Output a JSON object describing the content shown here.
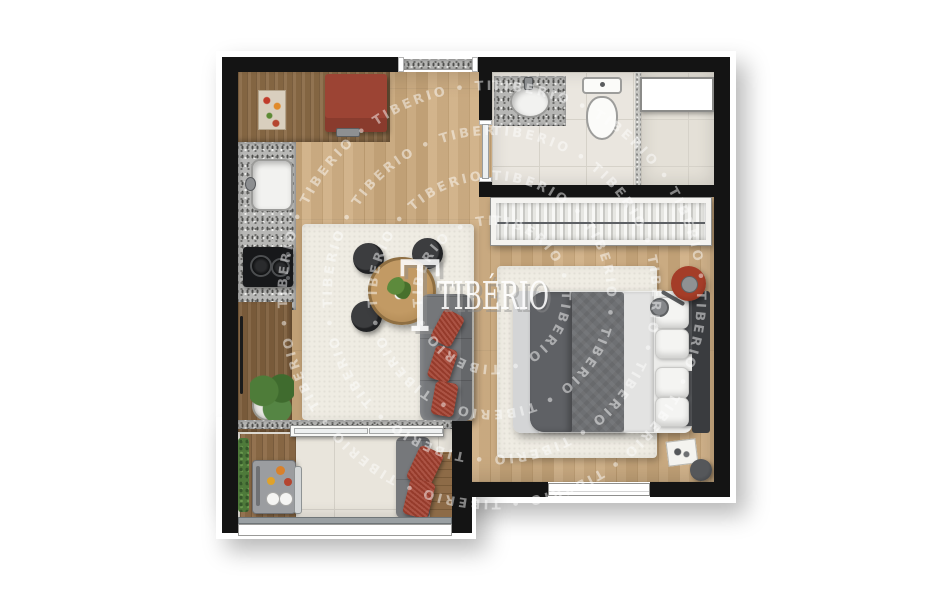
{
  "watermark": {
    "brand_logo_text": "TIBÉRIO",
    "logo_initial": "T",
    "ring_text": "TIBERIO • TIBERIO • TIBERIO • TIBERIO • TIBERIO • TIBERIO • TIBERIO • TIBERIO • TIBERIO • TIBERIO • TIBERIO • TIBERIO • TIBERIO • TIBERIO • TIBERIO • TIBERIO • TIBERIO • TIBERIO • "
  },
  "plan": {
    "kind": "studio-apartment-floor-plan",
    "rooms": {
      "kitchen": {
        "items": [
          "wood-counter-with-cutting-board",
          "red-refrigerator",
          "granite-counter-with-sink",
          "two-burner-cooktop",
          "tall-cabinet",
          "potted-plant"
        ]
      },
      "living_dining": {
        "items": [
          "area-rug",
          "round-dining-table-with-centerpiece",
          "black-chair-x3",
          "gray-sofa",
          "red-throw-pillow-x3"
        ]
      },
      "bedroom": {
        "items": [
          "area-rug",
          "double-bed-gray-duvet",
          "white-pillow-x4",
          "dark-accent-pillow-x2",
          "dark-headboard",
          "wardrobe-with-hanging-clothes",
          "red-round-side-table",
          "bedside-book",
          "round-stool",
          "window"
        ]
      },
      "bathroom": {
        "items": [
          "granite-vanity-with-sink",
          "toilet",
          "glass-partition",
          "shower-area",
          "wall-niche"
        ]
      },
      "balcony": {
        "items": [
          "sliding-glass-door",
          "wood-deck",
          "planter-hedge",
          "barbecue-grill-station",
          "plates",
          "gray-bench",
          "red-cushion-x2",
          "wood-ledge",
          "glass-railing"
        ]
      },
      "entrance": {
        "items": [
          "door-opening-with-granite-threshold"
        ]
      }
    },
    "colors": {
      "wall": "#141414",
      "wood_floor": "#cdab7e",
      "counter_wood": "#8a6a46",
      "tile": "#eae6df",
      "rug": "#efece3",
      "sofa_gray": "#75777a",
      "duvet_gray": "#6e7073",
      "accent_red": "#a2402f",
      "fridge_red": "#9c4434",
      "headboard": "#3a3c3f",
      "watermark": "#ffffff"
    }
  }
}
